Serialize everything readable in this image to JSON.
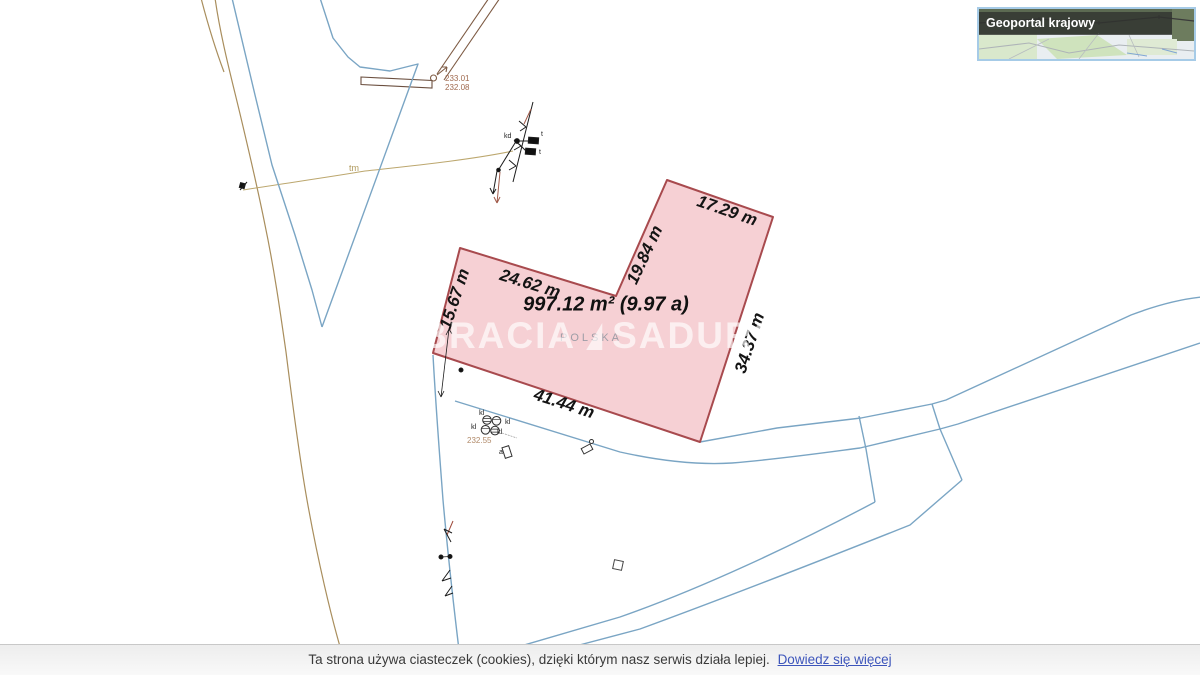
{
  "geoportal_widget": {
    "title": "Geoportal krajowy"
  },
  "parcel": {
    "area_label": "997.12 m² (9.97 a)",
    "dimensions": [
      {
        "edge": "west",
        "label": "15.67 m"
      },
      {
        "edge": "northwest",
        "label": "24.62 m"
      },
      {
        "edge": "inner-north",
        "label": "19.84 m"
      },
      {
        "edge": "northeast",
        "label": "17.29 m"
      },
      {
        "edge": "east",
        "label": "34.37 m"
      },
      {
        "edge": "south",
        "label": "41.44 m"
      }
    ]
  },
  "map_labels": {
    "place": "POLSKA",
    "utility_tm": "tm",
    "elev_233_01": "233.01",
    "elev_232_08": "232.08",
    "elev_232_55": "232.55",
    "manhole_kl": "kl",
    "transformer_t": "t",
    "annex_a": "a",
    "kd": "kd"
  },
  "watermark": {
    "brand_left": "BRACIA",
    "brand_right": "SADURSCY"
  },
  "cookie_bar": {
    "message": "Ta strona używa ciasteczek (cookies), dzięki którym nasz serwis działa lepiej.",
    "link_label": "Dowiedz się więcej"
  },
  "colors": {
    "parcel_fill": "#f5cace",
    "parcel_stroke": "#a84a4e",
    "boundary_blue": "#7aa5c4",
    "road_brown": "#a98e5d",
    "link_blue": "#3d55bb"
  }
}
